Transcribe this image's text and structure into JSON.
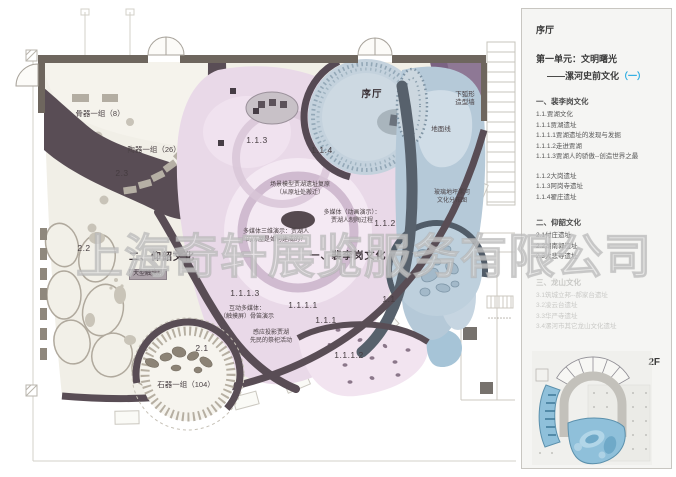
{
  "watermark": "上海奇轩展览服务有限公司",
  "colors": {
    "accent": "#29abe2",
    "wall": "#594d55",
    "pink_zone": "#e9d9e8",
    "blue_zone": "#b5c9d8",
    "cream_zone": "#f1efe7",
    "faded_text": "#c9c9c6"
  },
  "plan": {
    "labels": [
      {
        "text": "骨器一组（8）",
        "x": 100,
        "y": 109
      },
      {
        "text": "陶器一组（26）",
        "x": 154,
        "y": 145
      },
      {
        "text": "2.3",
        "x": 122,
        "y": 168
      },
      {
        "text": "2.2",
        "x": 84,
        "y": 243
      },
      {
        "text": "二、仰韶文化",
        "x": 162,
        "y": 251
      },
      {
        "text": "大型触摸屏",
        "x": 148,
        "y": 269
      },
      {
        "text": "2.1",
        "x": 202,
        "y": 343
      },
      {
        "text": "石器一组（104）",
        "x": 186,
        "y": 380
      },
      {
        "text": "序厅",
        "x": 372,
        "y": 89
      },
      {
        "text": "1.1.3",
        "x": 257,
        "y": 135
      },
      {
        "text": "1.1.4",
        "x": 322,
        "y": 145
      },
      {
        "text": "场景模型贾湖遗址复原\n（从原址处搬迁）",
        "x": 300,
        "y": 182
      },
      {
        "text": "多媒体（动画演示）：\n贾湖人制陶过程",
        "x": 352,
        "y": 210
      },
      {
        "text": "1.1.2",
        "x": 385,
        "y": 218
      },
      {
        "text": "多媒体三维演示：贾湖人\n的房屋是如何建成的？",
        "x": 276,
        "y": 229
      },
      {
        "text": "一、裴李岗文化",
        "x": 348,
        "y": 250
      },
      {
        "text": "1.1.1.3",
        "x": 245,
        "y": 288
      },
      {
        "text": "互动多媒体：\n（触摸屏）骨笛演示",
        "x": 247,
        "y": 306
      },
      {
        "text": "1.1.1.1",
        "x": 303,
        "y": 300
      },
      {
        "text": "1.1.1",
        "x": 326,
        "y": 315
      },
      {
        "text": "1.1",
        "x": 389,
        "y": 294
      },
      {
        "text": "感应投影贾湖\n先民的祭祀活动",
        "x": 271,
        "y": 330
      },
      {
        "text": "1.1.1.2",
        "x": 349,
        "y": 350
      },
      {
        "text": "地面线",
        "x": 441,
        "y": 126
      },
      {
        "text": "下弧形\n造型墙",
        "x": 465,
        "y": 91
      },
      {
        "text": "玻璃地坪漯河\n文化分布图",
        "x": 452,
        "y": 190
      }
    ]
  },
  "panel": {
    "hall_label": "序厅",
    "unit_title": "第一单元：文明曙光",
    "unit_subtitle": "——漯河史前文化",
    "unit_subtitle_accent": "（一）",
    "sections": [
      {
        "heading": "一、裴李岗文化",
        "items": [
          "1.1.贾湖文化",
          "1.1.1贾湖遗址",
          "1.1.1.1贾湖遗址的发现与发掘",
          "1.1.1.2走进贾湖",
          "1.1.1.3贾湖人的骄傲--创造世界之最",
          "1.1.2大岗遗址",
          "1.1.3阿岗寺遗址",
          "1.1.4翟庄遗址"
        ]
      },
      {
        "heading": "二、仰韶文化",
        "items": [
          "2.1付庄遗址",
          "2.2湖南郭遗址",
          "2.3大悲寺遗址"
        ]
      },
      {
        "heading": "三、龙山文化",
        "items": [
          "3.1筑城立邦--郝家台遗址",
          "3.2凌云台遗址",
          "3.3华严寺遗址",
          "3.4漯河市其它龙山文化遗址"
        ]
      }
    ],
    "floor_label": "2F"
  }
}
